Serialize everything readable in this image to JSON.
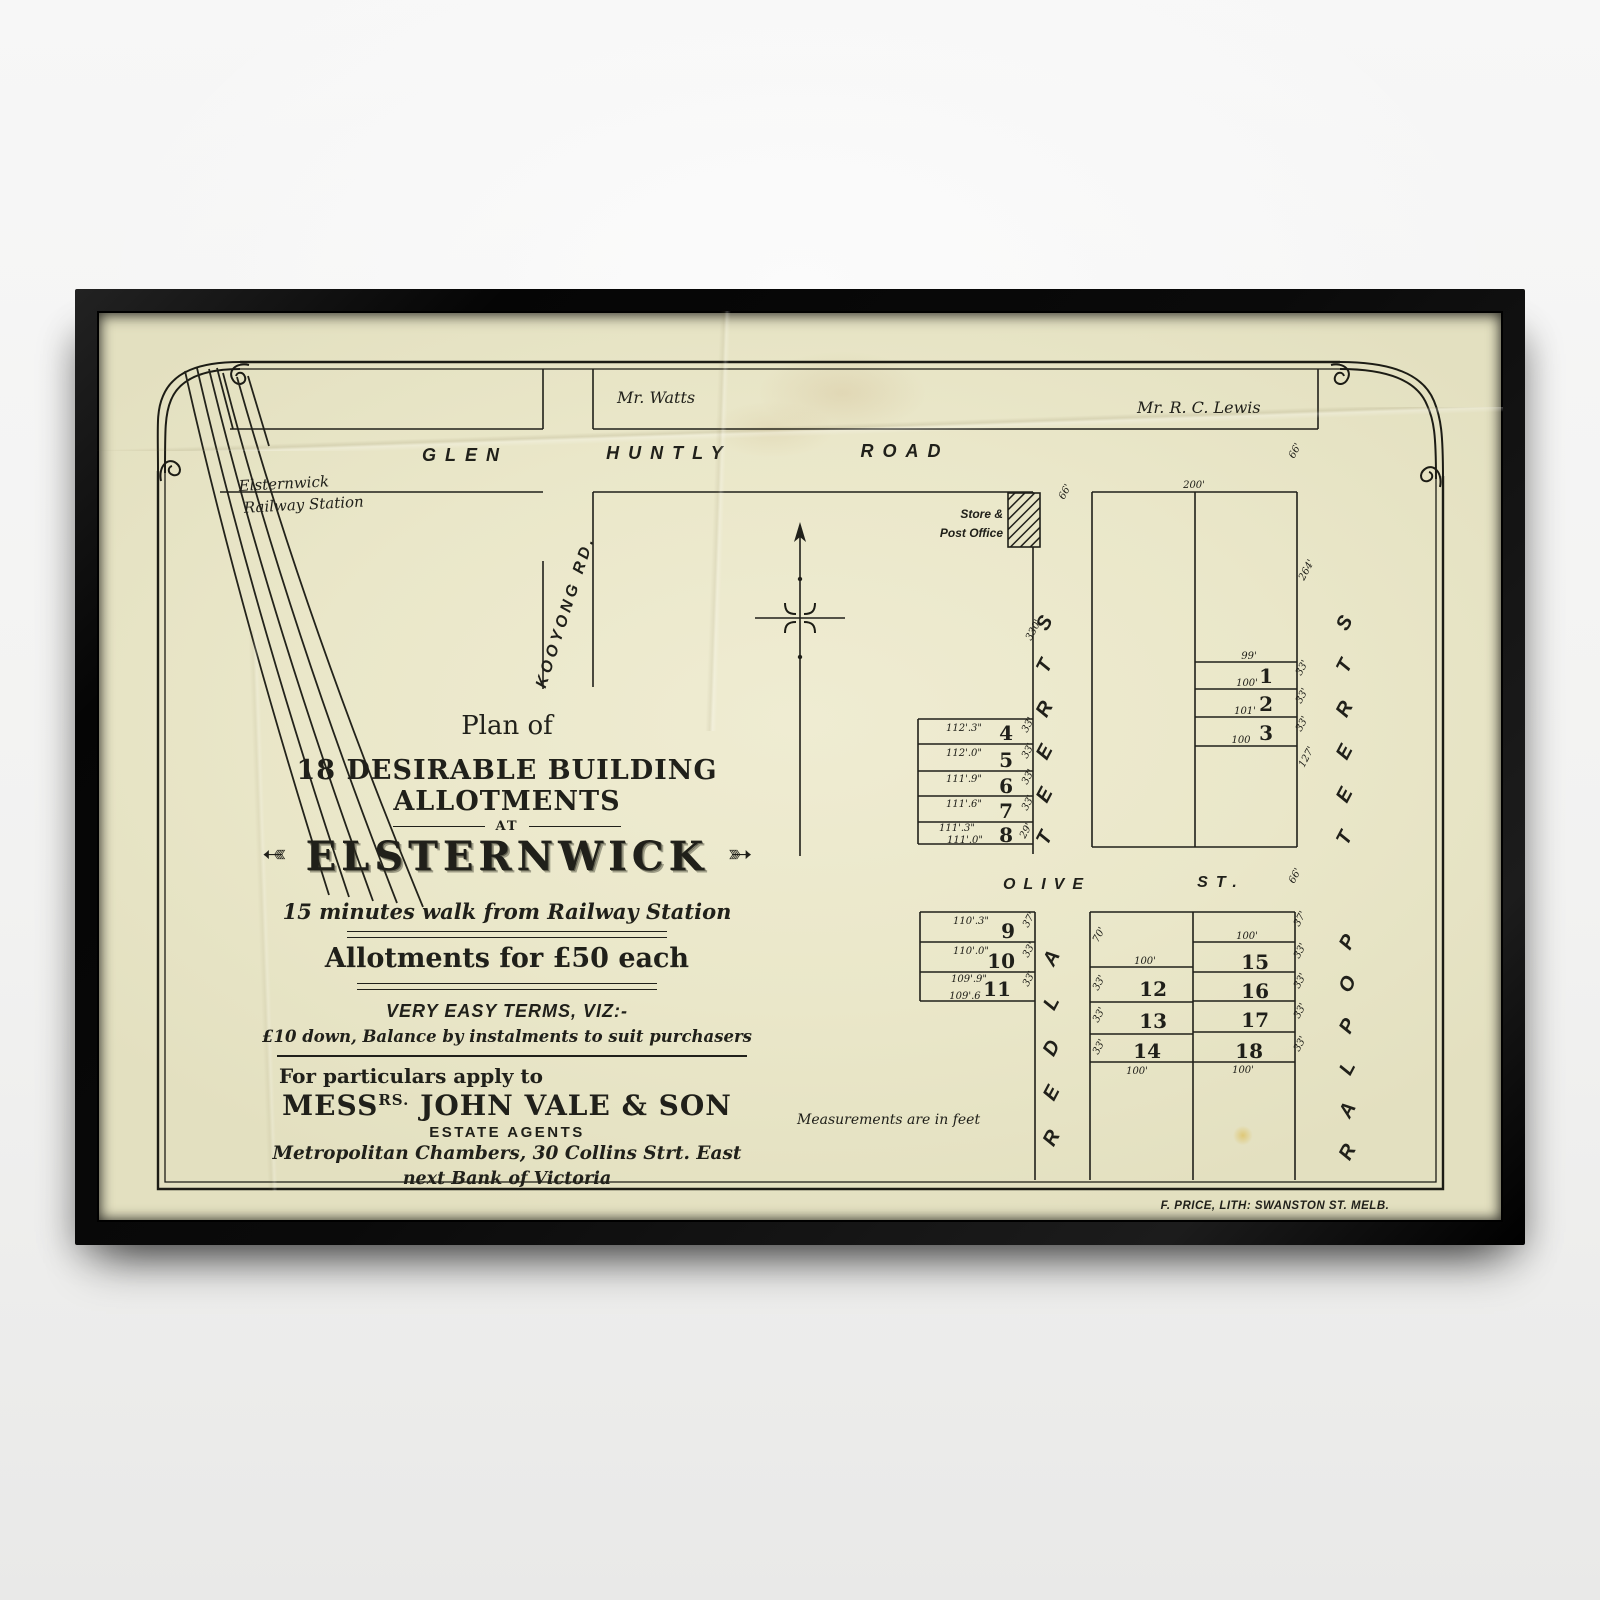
{
  "poster": {
    "plan_of": "Plan of",
    "headline": "18 DESIRABLE BUILDING ALLOTMENTS",
    "at": "AT",
    "estate": "ELSTERNWICK",
    "flourish": "➳",
    "walk": "15 minutes walk from Railway Station",
    "price": "Allotments for £50 each",
    "terms": "VERY EASY TERMS, VIZ:-",
    "terms_detail": "£10 down, Balance by instalments to suit purchasers",
    "apply": "For particulars apply to",
    "agent_prefix": "MESS",
    "agent_sup": "RS.",
    "agent_name": " JOHN VALE & SON",
    "agent_role": "ESTATE AGENTS",
    "address1": "Metropolitan Chambers, 30 Collins Strt. East",
    "address2": "next Bank of Victoria",
    "note": "Measurements are in feet",
    "credit": "F. PRICE, LITH: SWANSTON ST. MELB."
  },
  "map": {
    "roads": {
      "glen": "GLEN",
      "huntly": "HUNTLY",
      "road": "ROAD",
      "kooyong": "KOOYONG  RD.",
      "olive": "OLIVE",
      "olive_st": "ST."
    },
    "owners": {
      "watts": "Mr. Watts",
      "lewis": "Mr. R. C. Lewis"
    },
    "station_line1": "Elsternwick",
    "station_line2": "Railway Station",
    "store_line1": "Store &",
    "store_line2": "Post Office"
  },
  "letters": {
    "street": [
      "S",
      "T",
      "R",
      "E",
      "E",
      "T"
    ],
    "alder": [
      "A",
      "L",
      "D",
      "E",
      "R"
    ],
    "poplar": [
      "P",
      "O",
      "P",
      "L",
      "A",
      "R"
    ]
  },
  "lotnums": [
    "4",
    "5",
    "6",
    "7",
    "8",
    "1",
    "2",
    "3",
    "9",
    "10",
    "11",
    "12",
    "13",
    "14",
    "15",
    "16",
    "17",
    "18"
  ],
  "dims": [
    "112'.3\"",
    "112'.0\"",
    "111'.9\"",
    "111'.6\"",
    "111'.3\"",
    "111'.0\"",
    "33'",
    "33'",
    "33'",
    "33'",
    "29'",
    "200'",
    "99'",
    "100'",
    "101'",
    "100",
    "33'",
    "33'",
    "33'",
    "264'",
    "127'",
    "66'",
    "66'",
    "330'",
    "110'.3\"",
    "110'.0\"",
    "109'.9\"",
    "109'.6",
    "37'",
    "33'",
    "33'",
    "70'",
    "100'",
    "100'",
    "33'",
    "33'",
    "33'",
    "37'",
    "100'",
    "100'",
    "33'",
    "33'",
    "33'",
    "33'",
    "66'"
  ]
}
